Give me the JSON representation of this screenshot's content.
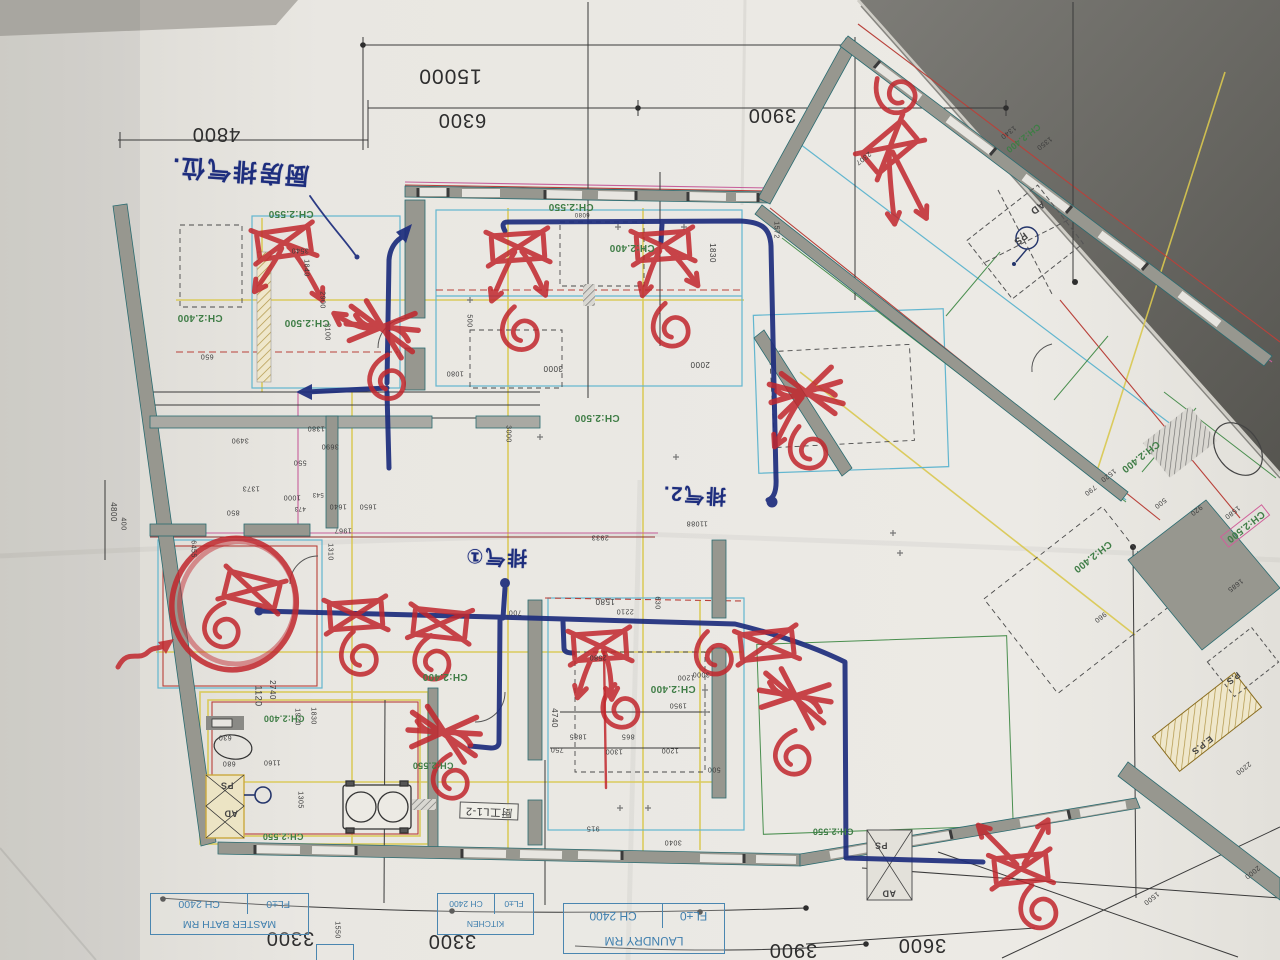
{
  "photo": {
    "paper_color": "#e7e5e0",
    "dark_corner_color": "#6f6e6a",
    "print_green": "#3f7d46",
    "print_blue": "#3f7fae",
    "marker_red": "#c1272d",
    "marker_navy": "#1d2d7d"
  },
  "handwritten": {
    "notes": [
      {
        "t": "厨房排气位.",
        "x": 240,
        "y": 170,
        "r": 184,
        "s": 24,
        "n": "note-kitchen-exhaust"
      },
      {
        "t": "排气①",
        "x": 496,
        "y": 556,
        "r": 182,
        "s": 20,
        "n": "note-exhaust-1"
      },
      {
        "t": "排气2.",
        "x": 694,
        "y": 494,
        "r": 183,
        "s": 20,
        "n": "note-exhaust-2"
      }
    ]
  },
  "paper": {
    "title_blocks": [
      {
        "room": "MASTER BATH RM",
        "fl": "FL±0",
        "ch": "CH 2400"
      },
      {
        "room": "LAUNDRY RM",
        "fl": "FL±0",
        "ch": "CH 2400"
      },
      {
        "room": "KITCHEN",
        "fl": "FL±0",
        "ch": "CH 2400"
      }
    ],
    "kitchen_detail_label": {
      "t": "厨工L1-2",
      "x": 489,
      "y": 811,
      "r": 182,
      "s": 11,
      "boxed": true,
      "n": "detail-ref-label"
    },
    "large_dims": [
      {
        "t": "15000",
        "x": 450,
        "y": 76,
        "s": 21
      },
      {
        "t": "6300",
        "x": 462,
        "y": 120,
        "s": 20
      },
      {
        "t": "4800",
        "x": 216,
        "y": 134,
        "s": 20
      },
      {
        "t": "3900",
        "x": 772,
        "y": 115,
        "s": 20
      },
      {
        "t": "3300",
        "x": 290,
        "y": 938,
        "s": 20
      },
      {
        "t": "3300",
        "x": 452,
        "y": 941,
        "s": 20
      },
      {
        "t": "3900",
        "x": 793,
        "y": 950,
        "s": 20
      },
      {
        "t": "3600",
        "x": 922,
        "y": 945,
        "s": 20
      }
    ],
    "ch_labels": [
      {
        "t": "CH:2.550",
        "x": 291,
        "y": 213,
        "s": 10
      },
      {
        "t": "CH:2.550",
        "x": 571,
        "y": 206,
        "s": 10
      },
      {
        "t": "CH:2.400",
        "x": 632,
        "y": 247,
        "s": 10
      },
      {
        "t": "CH:2.400",
        "x": 200,
        "y": 317,
        "s": 10
      },
      {
        "t": "CH:2.500",
        "x": 307,
        "y": 322,
        "s": 10
      },
      {
        "t": "CH:2.500",
        "x": 597,
        "y": 417,
        "s": 10
      },
      {
        "t": "CH:2.400",
        "x": 673,
        "y": 688,
        "s": 10
      },
      {
        "t": "CH:2.400",
        "x": 445,
        "y": 676,
        "s": 10
      },
      {
        "t": "CH:2.400",
        "x": 284,
        "y": 718,
        "s": 9
      },
      {
        "t": "CH:2.550",
        "x": 433,
        "y": 765,
        "s": 9
      },
      {
        "t": "CH:2.550",
        "x": 283,
        "y": 836,
        "s": 9
      },
      {
        "t": "CH:2.550",
        "x": 833,
        "y": 831,
        "s": 9
      },
      {
        "t": "CH:2.400",
        "x": 1140,
        "y": 456,
        "r": 142,
        "s": 10
      },
      {
        "t": "CH:2.400",
        "x": 1092,
        "y": 556,
        "r": 142,
        "s": 10
      },
      {
        "t": "CH:2.400",
        "x": 1023,
        "y": 138,
        "r": 142,
        "s": 9
      },
      {
        "t": "CH:2.500",
        "x": 1245,
        "y": 526,
        "r": 142,
        "s": 10,
        "pink": true
      }
    ],
    "shaft_labels": [
      {
        "t": "PS",
        "x": 227,
        "y": 785,
        "s": 9
      },
      {
        "t": "AD",
        "x": 231,
        "y": 813,
        "s": 9
      },
      {
        "t": "PS",
        "x": 881,
        "y": 845,
        "s": 9
      },
      {
        "t": "AD",
        "x": 889,
        "y": 893,
        "s": 9
      },
      {
        "t": "AD",
        "x": 1037,
        "y": 207,
        "r": 142,
        "s": 10
      },
      {
        "t": "PS",
        "x": 1020,
        "y": 238,
        "r": 142,
        "s": 10
      },
      {
        "t": "P.S",
        "x": 1233,
        "y": 678,
        "r": 142,
        "s": 9
      },
      {
        "t": "E.P.S",
        "x": 1202,
        "y": 745,
        "r": 142,
        "s": 9
      }
    ],
    "small_dims": [
      {
        "t": "1830",
        "x": 712,
        "y": 253,
        "r": 90
      },
      {
        "t": "1572",
        "x": 776,
        "y": 230,
        "r": 90,
        "s": 7
      },
      {
        "t": "2307",
        "x": 863,
        "y": 158,
        "r": 142,
        "s": 7
      },
      {
        "t": "6080",
        "x": 582,
        "y": 214,
        "s": 6
      },
      {
        "t": "3540",
        "x": 300,
        "y": 250,
        "s": 7
      },
      {
        "t": "1840",
        "x": 306,
        "y": 268,
        "r": 90,
        "s": 7
      },
      {
        "t": "2900",
        "x": 322,
        "y": 300,
        "r": 90,
        "s": 7
      },
      {
        "t": "2100",
        "x": 327,
        "y": 332,
        "r": 90,
        "s": 7
      },
      {
        "t": "500",
        "x": 469,
        "y": 321,
        "r": 90,
        "s": 7
      },
      {
        "t": "3000",
        "x": 553,
        "y": 368,
        "s": 8
      },
      {
        "t": "2000",
        "x": 700,
        "y": 364,
        "s": 8
      },
      {
        "t": "1080",
        "x": 455,
        "y": 373,
        "s": 7
      },
      {
        "t": "3000",
        "x": 508,
        "y": 434,
        "r": 90,
        "s": 7
      },
      {
        "t": "650",
        "x": 207,
        "y": 356,
        "s": 7
      },
      {
        "t": "1380",
        "x": 316,
        "y": 428,
        "s": 7
      },
      {
        "t": "3490",
        "x": 240,
        "y": 440,
        "s": 7
      },
      {
        "t": "3690",
        "x": 330,
        "y": 446,
        "s": 7
      },
      {
        "t": "550",
        "x": 300,
        "y": 462,
        "s": 7
      },
      {
        "t": "1373",
        "x": 251,
        "y": 488,
        "s": 7
      },
      {
        "t": "1000",
        "x": 292,
        "y": 497,
        "s": 7
      },
      {
        "t": "543",
        "x": 318,
        "y": 494,
        "s": 6
      },
      {
        "t": "473",
        "x": 300,
        "y": 508,
        "s": 6
      },
      {
        "t": "1640",
        "x": 338,
        "y": 506,
        "s": 7
      },
      {
        "t": "1650",
        "x": 368,
        "y": 506,
        "s": 7
      },
      {
        "t": "850",
        "x": 233,
        "y": 512,
        "s": 7
      },
      {
        "t": "4800",
        "x": 113,
        "y": 512,
        "r": 90,
        "s": 8
      },
      {
        "t": "400",
        "x": 123,
        "y": 524,
        "r": 90,
        "s": 7
      },
      {
        "t": "6455",
        "x": 193,
        "y": 549,
        "r": 90,
        "s": 7
      },
      {
        "t": "1967",
        "x": 343,
        "y": 530,
        "s": 7
      },
      {
        "t": "1310",
        "x": 330,
        "y": 552,
        "r": 90,
        "s": 7
      },
      {
        "t": "2933",
        "x": 600,
        "y": 537,
        "s": 7
      },
      {
        "t": "11088",
        "x": 697,
        "y": 523,
        "s": 7
      },
      {
        "t": "1580",
        "x": 605,
        "y": 601,
        "s": 8
      },
      {
        "t": "2210",
        "x": 625,
        "y": 611,
        "s": 7
      },
      {
        "t": "700",
        "x": 515,
        "y": 612,
        "s": 7
      },
      {
        "t": "630",
        "x": 657,
        "y": 603,
        "r": 90,
        "s": 7
      },
      {
        "t": "2580",
        "x": 598,
        "y": 657,
        "s": 7
      },
      {
        "t": "4740",
        "x": 554,
        "y": 718,
        "r": 90,
        "s": 8
      },
      {
        "t": "1885",
        "x": 578,
        "y": 736,
        "s": 7
      },
      {
        "t": "750",
        "x": 557,
        "y": 749,
        "s": 7
      },
      {
        "t": "865",
        "x": 628,
        "y": 736,
        "s": 7
      },
      {
        "t": "1300",
        "x": 614,
        "y": 751,
        "s": 7
      },
      {
        "t": "1200",
        "x": 670,
        "y": 750,
        "s": 7
      },
      {
        "t": "1950",
        "x": 678,
        "y": 705,
        "s": 7
      },
      {
        "t": "1200",
        "x": 686,
        "y": 677,
        "s": 7
      },
      {
        "t": "3000",
        "x": 701,
        "y": 674,
        "s": 7
      },
      {
        "t": "500",
        "x": 714,
        "y": 769,
        "s": 7
      },
      {
        "t": "1120",
        "x": 258,
        "y": 696,
        "r": 90,
        "s": 9
      },
      {
        "t": "2740",
        "x": 272,
        "y": 690,
        "r": 90,
        "s": 8
      },
      {
        "t": "1970",
        "x": 297,
        "y": 717,
        "r": 90,
        "s": 7
      },
      {
        "t": "1830",
        "x": 313,
        "y": 716,
        "r": 90,
        "s": 7
      },
      {
        "t": "630",
        "x": 225,
        "y": 737,
        "s": 7
      },
      {
        "t": "680",
        "x": 229,
        "y": 763,
        "s": 7
      },
      {
        "t": "1160",
        "x": 272,
        "y": 762,
        "s": 7
      },
      {
        "t": "1305",
        "x": 300,
        "y": 800,
        "r": 90,
        "s": 7
      },
      {
        "t": "915",
        "x": 593,
        "y": 828,
        "s": 7
      },
      {
        "t": "3040",
        "x": 673,
        "y": 842,
        "s": 7
      },
      {
        "t": "1550",
        "x": 337,
        "y": 930,
        "r": 90,
        "s": 7
      },
      {
        "t": "1340",
        "x": 1008,
        "y": 132,
        "r": 142,
        "s": 7
      },
      {
        "t": "1350",
        "x": 1044,
        "y": 143,
        "r": 142,
        "s": 7
      },
      {
        "t": "1520",
        "x": 1108,
        "y": 475,
        "r": 142,
        "s": 7
      },
      {
        "t": "790",
        "x": 1090,
        "y": 490,
        "r": 142,
        "s": 7
      },
      {
        "t": "500",
        "x": 1160,
        "y": 503,
        "r": 142,
        "s": 7
      },
      {
        "t": "920",
        "x": 1196,
        "y": 510,
        "r": 142,
        "s": 7
      },
      {
        "t": "1580",
        "x": 1232,
        "y": 512,
        "r": 142,
        "s": 7
      },
      {
        "t": "1685",
        "x": 1235,
        "y": 585,
        "r": 142,
        "s": 7
      },
      {
        "t": "960",
        "x": 1100,
        "y": 617,
        "r": 142,
        "s": 7
      },
      {
        "t": "2200",
        "x": 1243,
        "y": 768,
        "r": 142,
        "s": 7
      },
      {
        "t": "1500",
        "x": 1151,
        "y": 898,
        "r": 142,
        "s": 7
      },
      {
        "t": "2000",
        "x": 1252,
        "y": 872,
        "r": 142,
        "s": 7
      }
    ]
  },
  "fixtures": [
    {
      "n": "light-crossout-1",
      "x": 284,
      "y": 243,
      "rot": -8,
      "box": 1,
      "arrows": [
        [
          -10,
          16,
          -36,
          44
        ],
        [
          14,
          16,
          30,
          62
        ]
      ]
    },
    {
      "n": "light-crossout-2",
      "x": 382,
      "y": 328,
      "rot": 10,
      "scrib": 1,
      "spiral": [
        16,
        50
      ],
      "arrows": [
        [
          -24,
          6,
          -50,
          -6
        ]
      ]
    },
    {
      "n": "light-crossout-3",
      "x": 518,
      "y": 247,
      "rot": -4,
      "box": 1,
      "spiral": [
        -2,
        84
      ],
      "arrows": [
        [
          -12,
          16,
          -30,
          52
        ],
        [
          12,
          16,
          24,
          50
        ]
      ]
    },
    {
      "n": "light-crossout-4",
      "x": 663,
      "y": 246,
      "rot": -4,
      "box": 1,
      "spiral": [
        4,
        82
      ],
      "arrows": [
        [
          -12,
          16,
          -24,
          48
        ],
        [
          14,
          12,
          32,
          42
        ]
      ]
    },
    {
      "n": "light-crossout-5",
      "x": 890,
      "y": 147,
      "rot": -40,
      "box": 1,
      "spiral": [
        40,
        -36
      ],
      "arrows": [
        [
          -14,
          14,
          -46,
          62
        ],
        [
          -4,
          18,
          -18,
          78
        ]
      ]
    },
    {
      "n": "light-crossout-6",
      "x": 806,
      "y": 393,
      "rot": -12,
      "scrib": 1,
      "spiral": [
        -8,
        56
      ],
      "arrows": [
        [
          -16,
          12,
          -42,
          46
        ]
      ]
    },
    {
      "n": "light-crossout-7",
      "x": 252,
      "y": 590,
      "rot": 14,
      "box": 1,
      "bigcircle": [
        -14,
        18,
        62,
        66
      ],
      "spiral": [
        -18,
        44
      ]
    },
    {
      "n": "light-crossout-8",
      "x": 356,
      "y": 615,
      "rot": -4,
      "box": 1,
      "spiral": [
        2,
        41
      ]
    },
    {
      "n": "light-crossout-9",
      "x": 440,
      "y": 624,
      "rot": 6,
      "box": 1,
      "spiral": [
        -2,
        37
      ]
    },
    {
      "n": "light-crossout-10",
      "x": 600,
      "y": 646,
      "rot": -4,
      "box": 1,
      "spiral": [
        18,
        64
      ],
      "arrows": [
        [
          -14,
          16,
          -26,
          50
        ],
        [
          10,
          18,
          8,
          54
        ]
      ]
    },
    {
      "n": "light-crossout-11",
      "x": 444,
      "y": 733,
      "rot": 8,
      "scrib": 1,
      "spiral": [
        15,
        45
      ]
    },
    {
      "n": "light-crossout-12",
      "x": 767,
      "y": 645,
      "rot": -6,
      "box": 1,
      "spiral": [
        -52,
        5
      ]
    },
    {
      "n": "light-crossout-13",
      "x": 795,
      "y": 697,
      "rot": 14,
      "scrib": 1,
      "spiral": [
        14,
        57
      ]
    },
    {
      "n": "light-crossout-14",
      "x": 1021,
      "y": 869,
      "rot": -6,
      "box": 1,
      "spiral": [
        15,
        42
      ],
      "arrows": [
        [
          -12,
          -16,
          -38,
          -48
        ],
        [
          12,
          -16,
          32,
          -46
        ]
      ]
    }
  ]
}
